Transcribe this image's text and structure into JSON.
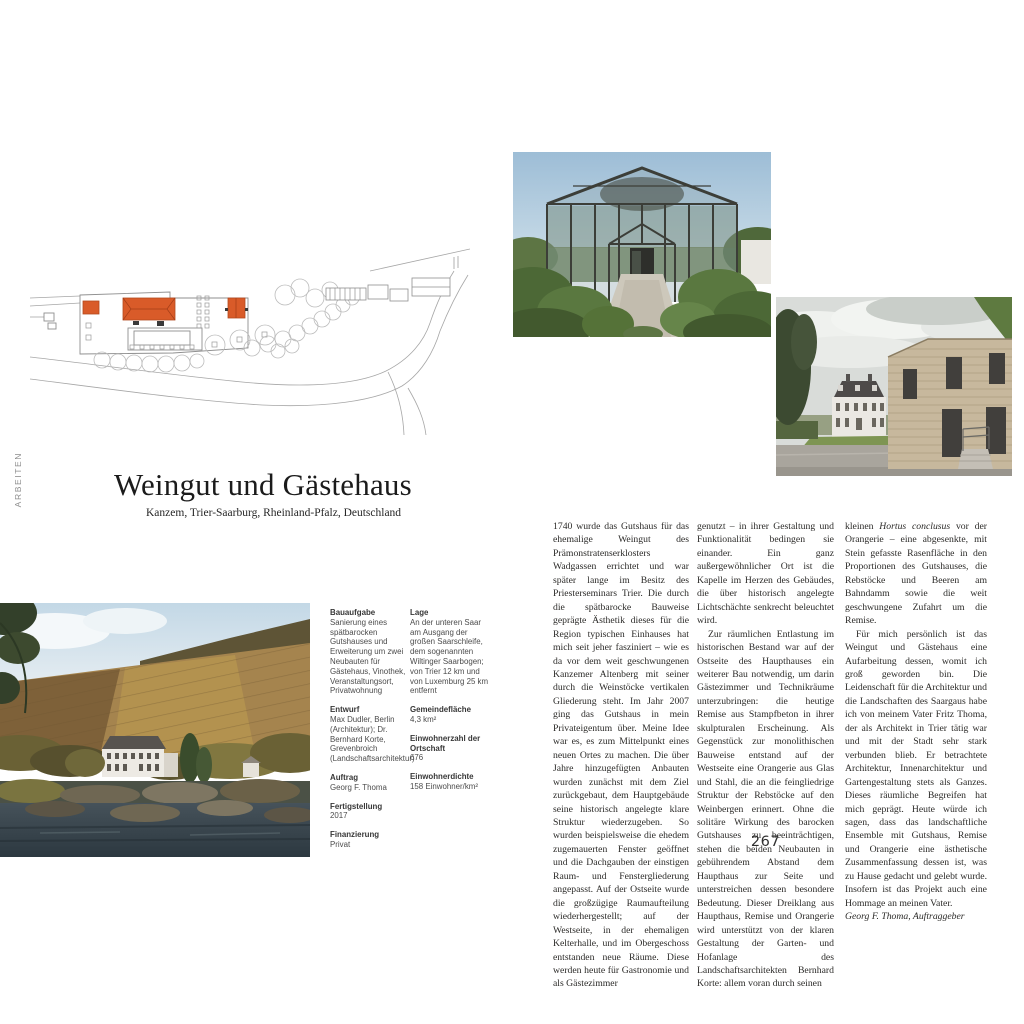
{
  "page": {
    "side_label": "ARBEITEN",
    "page_number": "267"
  },
  "header": {
    "title": "Weingut und Gästehaus",
    "subtitle": "Kanzem, Trier-Saarburg, Rheinland-Pfalz, Deutschland"
  },
  "colors": {
    "plan_accent_orange": "#d95b29",
    "plan_line_gray": "#9b9b9b"
  },
  "meta": {
    "project": [
      {
        "label": "Bauaufgabe",
        "value": "Sanierung eines spätbarocken Gutshauses und Erweiterung um zwei Neubauten für Gästehaus, Vinothek, Veranstaltungsort, Privatwohnung"
      },
      {
        "label": "Entwurf",
        "value": "Max Dudler, Berlin (Architektur); Dr. Bernhard Korte, Grevenbroich (Landschaftsarchitektur)"
      },
      {
        "label": "Auftrag",
        "value": "Georg F. Thoma"
      },
      {
        "label": "Fertigstellung",
        "value": "2017"
      },
      {
        "label": "Finanzierung",
        "value": "Privat"
      }
    ],
    "location": [
      {
        "label": "Lage",
        "value": "An der unteren Saar am Ausgang der großen Saarschleife, dem sogenannten Wiltinger Saarbogen; von Trier 12 km und von Luxemburg 25 km entfernt"
      },
      {
        "label": "Gemeindefläche",
        "value": "4,3 km²"
      },
      {
        "label": "Einwohnerzahl der Ortschaft",
        "value": "676"
      },
      {
        "label": "Einwohnerdichte",
        "value": "158 Einwohner/km²"
      }
    ]
  },
  "article": {
    "col1": {
      "p1": "1740 wurde das Gutshaus für das ehemalige Weingut des Prämonstratenserklosters Wadgassen errichtet und war später lange im Besitz des Priesterseminars Trier. Die durch die spätbarocke Bauweise geprägte Ästhetik dieses für die Region typischen Einhauses hat mich seit jeher fasziniert – wie es da vor dem weit geschwungenen Kanzemer Altenberg mit seiner durch die Weinstöcke vertikalen Gliederung steht. Im Jahr 2007 ging das Gutshaus in mein Privateigentum über. Meine Idee war es, es zum Mittelpunkt eines neuen Ortes zu machen. Die über Jahre hinzugefügten Anbauten wurden zunächst mit dem Ziel zurückgebaut, dem Hauptgebäude seine historisch angelegte klare Struktur wiederzugeben. So wurden beispielsweise die ehedem zugemauerten Fenster geöffnet und die Dachgauben der einstigen Raum- und Fenstergliederung angepasst. Auf der Ostseite wurde die großzügige Raumaufteilung wiederhergestellt; auf der Westseite, in der ehemaligen Kelterhalle, und im Obergeschoss entstanden neue Räume. Diese werden heute für Gastronomie und als Gästezimmer"
    },
    "col2": {
      "p1": "genutzt – in ihrer Gestaltung und Funktionalität bedingen sie einander. Ein ganz außergewöhnlicher Ort ist die Kapelle im Herzen des Gebäudes, die über historisch angelegte Lichtschächte senkrecht beleuchtet wird.",
      "p2": "Zur räumlichen Entlastung im historischen Bestand war auf der Ostseite des Haupthauses ein weiterer Bau notwendig, um darin Gästezimmer und Technikräume unterzubringen: die heutige Remise aus Stampfbeton in ihrer skulpturalen Erscheinung. Als Gegenstück zur monolithischen Bauweise entstand auf der Westseite eine Orangerie aus Glas und Stahl, die an die feingliedrige Struktur der Rebstöcke auf den Weinbergen erinnert. Ohne die solitäre Wirkung des barocken Gutshauses zu beeinträchtigen, stehen die beiden Neubauten in gebührendem Abstand dem Haupthaus zur Seite und unterstreichen dessen besondere Bedeutung. Dieser Dreiklang aus Haupthaus, Remise und Orangerie wird unterstützt von der klaren Gestaltung der Garten- und Hofanlage des Landschaftsarchitekten Bernhard Korte: allem voran durch seinen"
    },
    "col3": {
      "p1_pre": "kleinen ",
      "p1_italic": "Hortus conclusus",
      "p1_post": " vor der Orangerie – eine abgesenkte, mit Stein gefasste Rasenfläche in den Proportionen des Gutshauses, die Rebstöcke und Beeren am Bahndamm sowie die weit geschwungene Zufahrt um die Remise.",
      "p2": "Für mich persönlich ist das Weingut und Gästehaus eine Aufarbeitung dessen, womit ich groß geworden bin. Die Leidenschaft für die Architektur und die Landschaften des Saargaus habe ich von meinem Vater Fritz Thoma, der als Architekt in Trier tätig war und mit der Stadt sehr stark verbunden blieb. Er betrachtete Architektur, Innenarchitektur und Gartengestaltung stets als Ganzes. Dieses räumliche Begreifen hat mich geprägt. Heute würde ich sagen, dass das landschaftliche Ensemble mit Gutshaus, Remise und Orangerie eine ästhetische Zusammenfassung dessen ist, was zu Hause gedacht und gelebt wurde. Insofern ist das Projekt auch eine Hommage an meinen Vater.",
      "signature": "Georg F. Thoma, Auftraggeber"
    }
  }
}
